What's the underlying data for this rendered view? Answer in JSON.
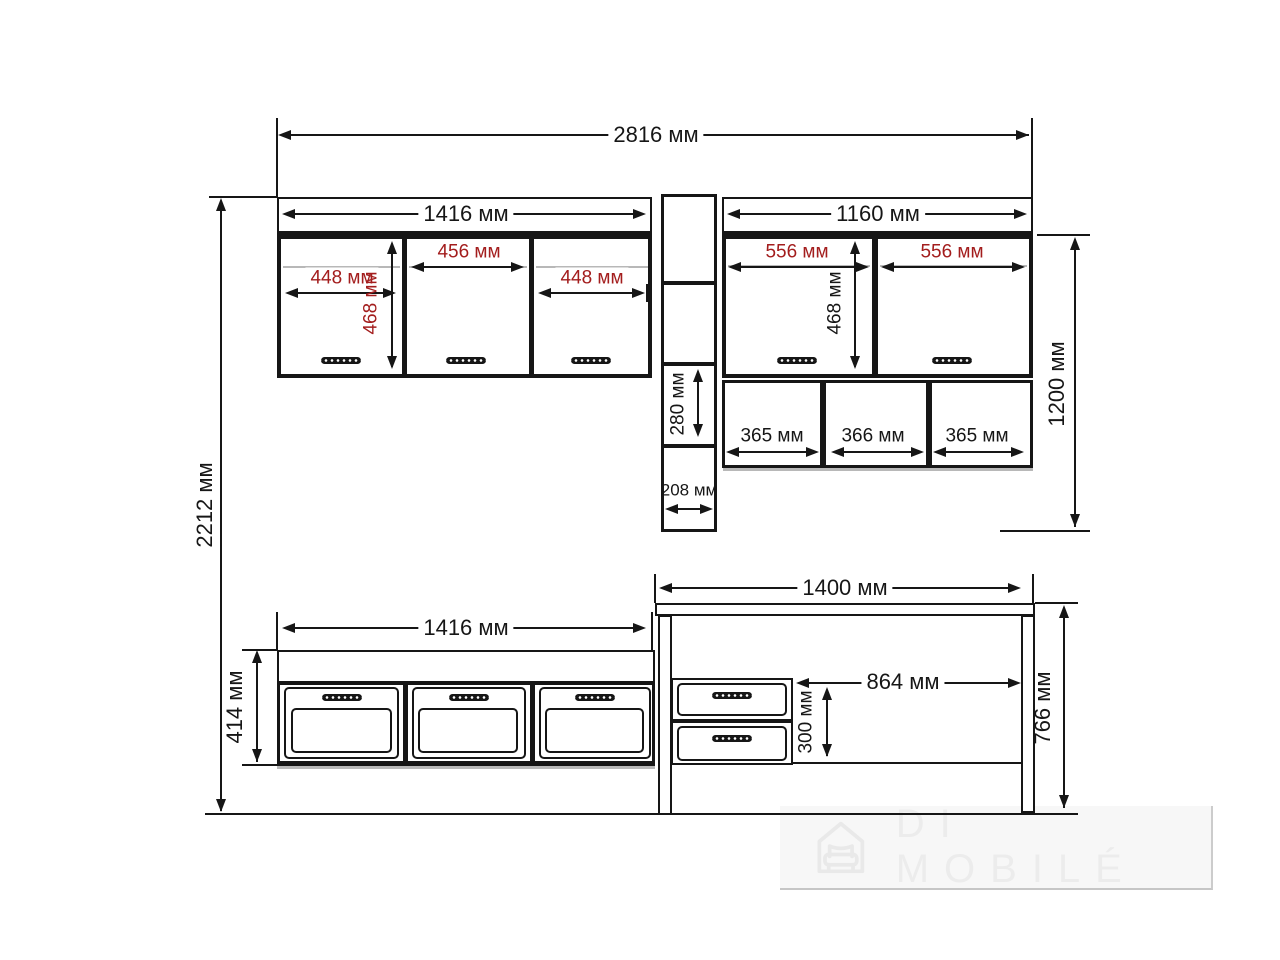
{
  "dims": {
    "w2816": "2816 мм",
    "h2212": "2212 мм",
    "w1416_top": "1416 мм",
    "w1160": "1160 мм",
    "d448a": "448 мм",
    "d456": "456 мм",
    "d448b": "448 мм",
    "h468_left": "468 мм",
    "d556a": "556 мм",
    "d556b": "556 мм",
    "h468_right": "468 мм",
    "h280": "280 мм",
    "w208": "208 мм",
    "s365a": "365 мм",
    "s366": "366 мм",
    "s365b": "365 мм",
    "h1200": "1200 мм",
    "w1416_bottom": "1416 мм",
    "h414": "414 мм",
    "w1400": "1400 мм",
    "w864": "864 мм",
    "h300": "300 мм",
    "h766": "766 мм"
  },
  "watermark": {
    "brand": "DI MOBILÉ",
    "icon": "house-sofa-icon"
  },
  "colors": {
    "line_black": "#161616",
    "dimension_red": "#a31d1d",
    "shadow_gray": "#b8b8b8",
    "watermark_gray": "#ececec"
  }
}
